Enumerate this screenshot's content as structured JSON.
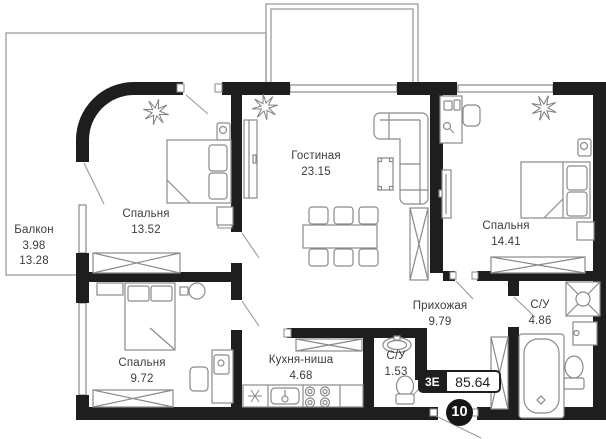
{
  "rooms": {
    "balcony": {
      "name": "Балкон",
      "area": "3.98",
      "area2": "13.28"
    },
    "bedroom_top_left": {
      "name": "Спальня",
      "area": "13.52"
    },
    "living_room": {
      "name": "Гостиная",
      "area": "23.15"
    },
    "bedroom_right": {
      "name": "Спальня",
      "area": "14.41"
    },
    "hallway": {
      "name": "Прихожая",
      "area": "9.79"
    },
    "bathroom_main": {
      "name": "С/У",
      "area": "4.86"
    },
    "bedroom_bottom_left": {
      "name": "Спальня",
      "area": "9.72"
    },
    "kitchen_niche": {
      "name": "Кухня-ниша",
      "area": "4.68"
    },
    "bathroom_small": {
      "name": "С/У",
      "area": "1.53"
    }
  },
  "badge": {
    "layout_type": "3Е",
    "total_area": "85.64"
  },
  "apartment_number": "10",
  "colors": {
    "wall": "#1e1e1c",
    "outline": "#8a8a8a",
    "text": "#3c3c3b",
    "background": "#ffffff"
  }
}
